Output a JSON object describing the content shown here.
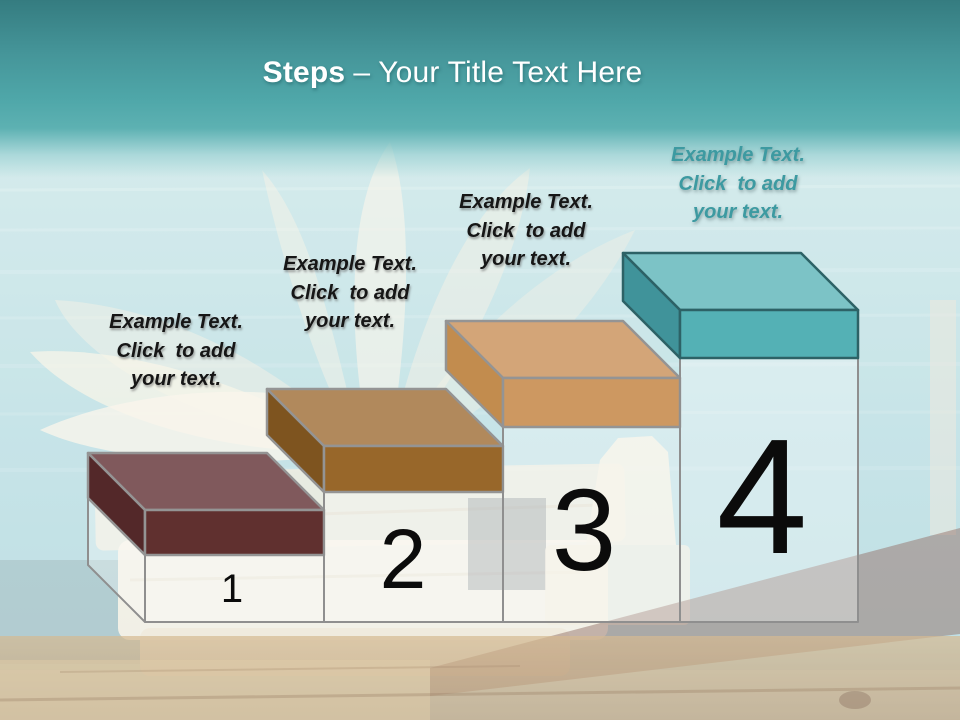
{
  "slide_title": {
    "bold": "Steps",
    "rest": "– Your Title Text Here"
  },
  "box_frame": {
    "depth": 57,
    "base_y": 622,
    "stroke": "#8f8f8f",
    "fill": "rgba(255,255,255,0.30)"
  },
  "steps": [
    {
      "number": "1",
      "label": "Example Text.\nClick  to add\nyour text.",
      "label_color": "#161616",
      "colors": {
        "top": "#80595c",
        "front": "#60302f",
        "side": "#532829",
        "stroke": "#949494"
      },
      "geometry": {
        "x1": 145,
        "x2": 324,
        "lid_front_top_y": 510,
        "lid_bottom_y": 555,
        "show_back_frame": true
      }
    },
    {
      "number": "2",
      "label": "Example Text.\nClick  to add\nyour text.",
      "label_color": "#161616",
      "colors": {
        "top": "#b1895c",
        "front": "#98672a",
        "side": "#7e541f",
        "stroke": "#949494"
      },
      "geometry": {
        "x1": 324,
        "x2": 503,
        "lid_front_top_y": 446,
        "lid_bottom_y": 492,
        "show_back_frame": false
      }
    },
    {
      "number": "3",
      "label": "Example Text.\nClick  to add\nyour text.",
      "label_color": "#161616",
      "colors": {
        "top": "#d3a578",
        "front": "#cd9861",
        "side": "#c28c4e",
        "stroke": "#949494"
      },
      "geometry": {
        "x1": 503,
        "x2": 680,
        "lid_front_top_y": 378,
        "lid_bottom_y": 427,
        "show_back_frame": false
      }
    },
    {
      "number": "4",
      "label": "Example Text.\nClick  to add\nyour text.",
      "label_color": "#3d9aa1",
      "colors": {
        "top": "#7cc3c6",
        "front": "#54b1b5",
        "side": "#40939a",
        "stroke": "#2d6266"
      },
      "geometry": {
        "x1": 680,
        "x2": 858,
        "lid_front_top_y": 310,
        "lid_bottom_y": 358,
        "show_back_frame": false
      }
    }
  ]
}
